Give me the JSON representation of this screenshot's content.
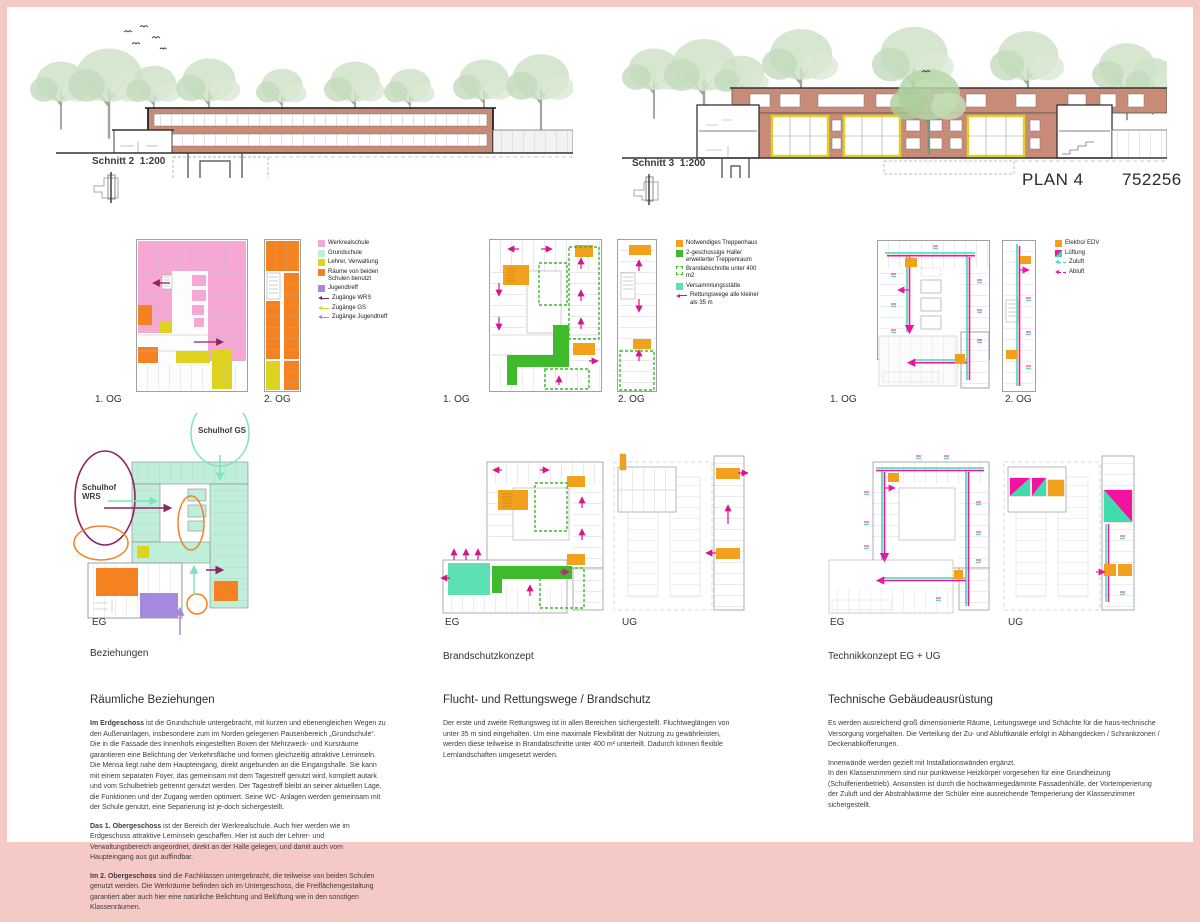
{
  "board": {
    "plan_label": "PLAN 4",
    "plan_number": "752256",
    "schnitt2": "Schnitt 2  1:200",
    "schnitt3": "Schnitt 3  1:200"
  },
  "labels": {
    "og1": "1. OG",
    "og2": "2. OG",
    "eg": "EG",
    "ug": "UG"
  },
  "group1": {
    "title": "Beziehungen",
    "legend": [
      "Werkrealschule",
      "Grundschule",
      "Lehrer, Verwaltung",
      "Räume von beiden Schulen benutzt",
      "Jugendtreff",
      "Zugänge WRS",
      "Zugänge GS",
      "Zugänge Jugendtreff"
    ],
    "annotation_wrs": "Schulhof WRS",
    "annotation_gs": "Schulhof GS"
  },
  "group2": {
    "title": "Brandschutzkonzept",
    "legend": [
      "Notwendiges Treppenhaus",
      "2-geschossige Halle/ erweiterter Treppenraum",
      "Brandabschnitte unter 400 m2",
      "Versammlungsstätte",
      "Rettungswege alle kleiner als 35 m"
    ]
  },
  "group3": {
    "title": "Technikkonzept EG + UG",
    "legend": [
      "Elektro/ EDV",
      "Lüftung",
      "Zuluft",
      "Abluft"
    ]
  },
  "text1": {
    "title": "Räumliche Beziehungen",
    "p1_lead": "Im Erdgeschoss",
    "p1": " ist die Grundschule untergebracht, mit kurzen und ebenengleichen Wegen zu den Außenanlagen, insbesondere zum im Norden gelegenen Pausenbereich „Grundschule“. Die in die Fassade des Innenhofs eingestellten Boxen der Mehrzweck- und Kursräume garantieren eine Belichtung der Verkehrsfläche und formen gleichzeitig attraktive Lerninseln. Die Mensa liegt nahe dem Haupteingang, direkt angebunden an die Eingangshalle. Sie kann mit einem separaten Foyer, das gemeinsam mit dem Tagestreff genutzt wird, komplett autark und vom Schulbetrieb getrennt genutzt werden. Der Tagestreff bleibt an seiner aktuellen Lage, die Funktionen und der Zugang werden optimiert. Seine WC- Anlagen werden gemeinsam mit der Schule genutzt, eine Separierung ist je-doch sichergestellt.",
    "p2_lead": "Das 1. Obergeschoss",
    "p2": " ist der Bereich der Werkrealschule. Auch hier werden wie im Erdgeschoss attraktive Lerninseln geschaffen. Hier ist auch der Lehrer- und Verwaltungsbereich angeordnet, direkt an der Halle gelegen, und damit auch vom Haupteingang aus gut auffindbar.",
    "p3_lead": "Im 2. Obergeschoss",
    "p3": " sind die Fachklassen untergebracht, die teilweise von beiden Schulen genutzt werden. Die Werkräume befinden sich im Untergeschoss, die Freiflächengestaltung garantiert aber auch hier eine natürliche Belichtung und Belüftung wie in den sonstigen Klassenräumen."
  },
  "text2": {
    "title": "Flucht- und Rettungswege / Brandschutz",
    "p1": "Der erste und zweite Rettungsweg ist in allen Bereichen sichergestellt. Fluchtweglängen von unter 35 m sind eingehalten. Um eine maximale Flexibilität der Nutzung zu gewährleisten, werden diese teilweise in Brandabschnitte unter 400 m² unterteilt. Dadurch können flexible Lernlandschaften umgesetzt werden."
  },
  "text3": {
    "title": "Technische Gebäudeausrüstung",
    "p1": "Es werden ausreichend groß dimensionierte Räume, Leitungswege und Schächte für die haus-technische Versorgung vorgehalten. Die Verteilung der Zu- und Abluftkanäle erfolgt in Abhangdecken / Schrankzonen / Deckenabkofferungen.",
    "p2": "Innenwände werden gezielt mit Installationswänden ergänzt.",
    "p3": "In den Klassenzimmern sind nur punktweise Heizkörper vorgesehen für eine Grundheizung (Schulferienbetrieb). Ansonsten ist durch die hochwärmegedämmte Fassadenhülle, der Vortemperierung der Zuluft und der Abstrahlwärme der Schüler eine ausreichende Temperierung der Klassenzimmer sichergestellt."
  },
  "colors": {
    "pink": "#F6A8D5",
    "mint": "#BFEFDA",
    "yellow": "#DED41F",
    "orange": "#F58220",
    "purple": "#A489DE",
    "magenta_dark": "#8E2463",
    "green": "#3FBA2A",
    "mint_bright": "#5CE0B4",
    "orange_amber": "#F2A11C",
    "magenta": "#D6158C",
    "tech_magenta": "#F213A0",
    "tech_mint": "#40DCAC",
    "frame": "#F5C9C6",
    "brick": "#CD8F7B"
  }
}
